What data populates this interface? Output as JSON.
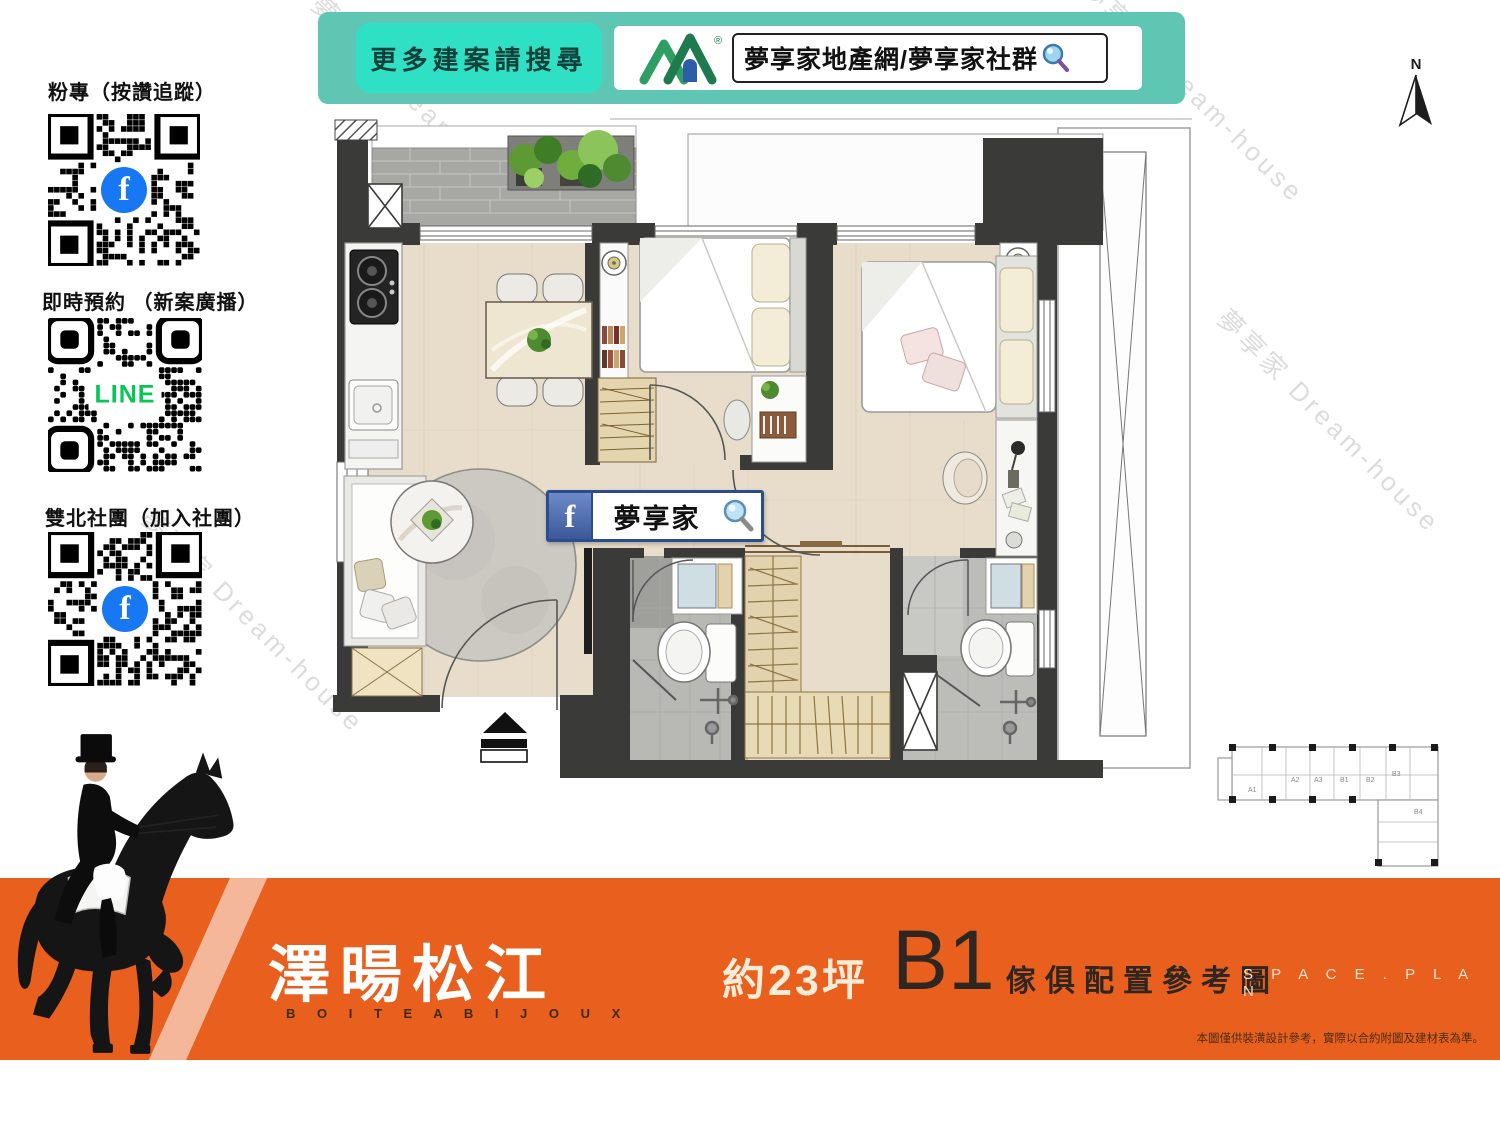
{
  "banner": {
    "search_prompt": "更多建案請搜尋",
    "brand": "夢享家地產網/夢享家社群",
    "logo_registered": "®"
  },
  "north": {
    "label": "N"
  },
  "qr_sections": [
    {
      "label": "粉專（按讚追蹤）",
      "logo": "facebook",
      "logo_glyph": "f"
    },
    {
      "label": "即時預約 （新案廣播）",
      "logo": "line",
      "logo_text": "LINE"
    },
    {
      "label": "雙北社團（加入社團）",
      "logo": "facebook",
      "logo_glyph": "f"
    }
  ],
  "fb_bar": {
    "icon_glyph": "f",
    "text": "夢享家"
  },
  "footer": {
    "project_name": "澤暘松江",
    "project_subtitle": "B O I T E   A   B I J O U X",
    "area": "約23坪",
    "unit": "B1",
    "caption": "傢俱配置參考圖",
    "caption_en": "S P A C E . P L A N",
    "disclaimer": "本圖僅供裝潢設計參考，實際以合約附圖及建材表為準。"
  },
  "keyplan": {
    "labels": [
      "A1",
      "A2",
      "A3",
      "B1",
      "B2",
      "B3",
      "B4"
    ]
  },
  "watermark": "夢享家 Dream-house",
  "colors": {
    "teal": "#5fc6b4",
    "teal_bright": "#2fe0c4",
    "orange": "#e95f1e",
    "facebook_blue": "#1877f2",
    "line_green": "#06c755",
    "search_border_blue": "#2b4d8f",
    "wall_dark": "#3a3a38",
    "floor_beige": "#e7ddca"
  }
}
